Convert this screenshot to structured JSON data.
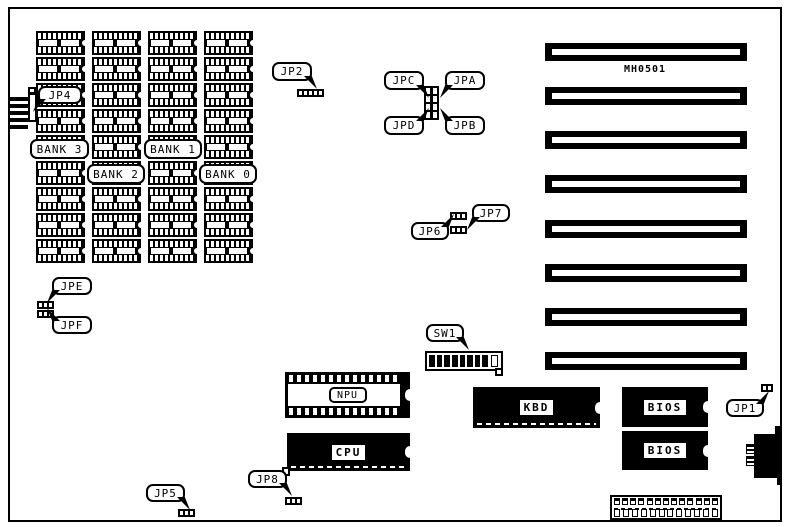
{
  "board": {
    "model_label": "MH0501",
    "memory": {
      "columns": 4,
      "chips_per_column": 9,
      "bank_labels": {
        "bank3": "BANK 3",
        "bank2": "BANK 2",
        "bank1": "BANK 1",
        "bank0": "BANK 0"
      }
    },
    "callouts": {
      "jp1": "JP1",
      "jp2": "JP2",
      "jp4": "JP4",
      "jp5": "JP5",
      "jp6": "JP6",
      "jp7": "JP7",
      "jp8": "JP8",
      "jpa": "JPA",
      "jpb": "JPB",
      "jpc": "JPC",
      "jpd": "JPD",
      "jpe": "JPE",
      "jpf": "JPF",
      "sw1": "SW1"
    },
    "chips": {
      "npu": "NPU",
      "cpu": "CPU",
      "kbd": "KBD",
      "bios_top": "BIOS",
      "bios_bottom": "BIOS"
    },
    "slots": {
      "count": 8
    },
    "switch": {
      "closed_count": 8,
      "open_count": 1
    },
    "jumpers": {
      "jp1_pins": 2,
      "jp2_pins": 5,
      "jp5_pins": 3,
      "jp6_pins": 3,
      "jp7_pins": 3,
      "jp8_pins": 3,
      "jpe_pins": 3,
      "jpf_pins": 3,
      "center_pins": 8
    },
    "bottom_connector": {
      "top_pins": 13,
      "bottom_cells": 12
    },
    "left_connector": {
      "fingers": 5
    }
  }
}
